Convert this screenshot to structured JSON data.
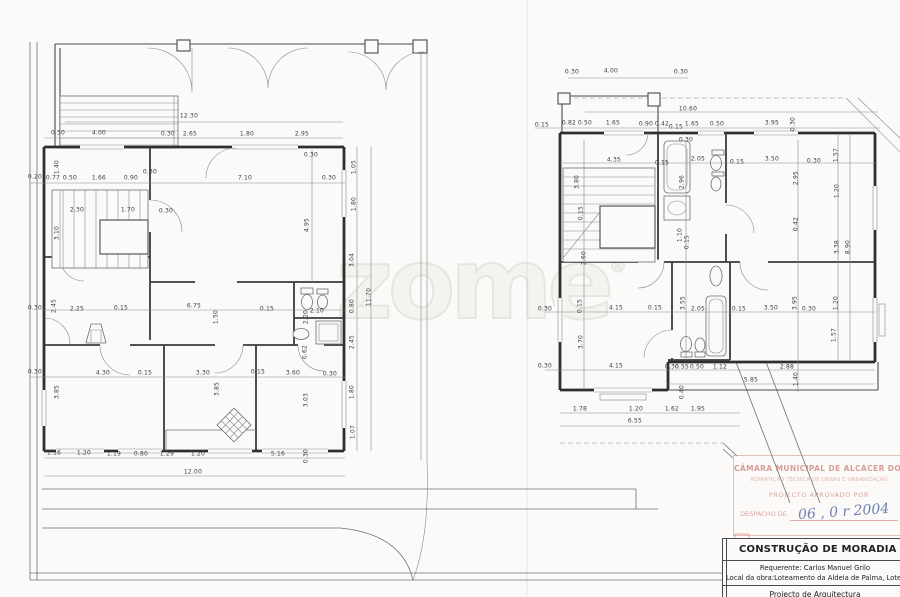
{
  "document": {
    "kind": "scanned architectural floor-plan sheet",
    "sheets": [
      "ground-floor-plan",
      "first-floor-plan"
    ]
  },
  "colors": {
    "paper": "#fbfaf8",
    "ink": "#3a3a3a",
    "stamp_red": "#c2645a",
    "handwriting_blue": "#5a6ba8",
    "watermark_gray": "#e9e9e5"
  },
  "watermark": {
    "text": "zome",
    "reg": "®"
  },
  "stamp": {
    "l1": "CÂMARA MUNICIPAL DE ALCÁCER DO SAL",
    "l2": "REPARTIÇÃO TÉCNICA DE OBRAS E URBANIZAÇÃO",
    "l3": "PROJECTO APROVADO POR",
    "l4": "DESPACHO DE",
    "handwritten": "06 , 0 r 2004"
  },
  "title_block": {
    "row1": "CONSTRUÇÃO DE MORADIA UNIFA",
    "row2": "Requerente: Carlos Manuel Grilo",
    "row3": "Local da obra:Loteamento da Aldeia de Palma, Lote 8",
    "row4": "Projecto de Arquitectura"
  },
  "fixtures_icons": [
    "stairs",
    "door-arc",
    "bathtub",
    "toilet",
    "bidet",
    "sink",
    "shower",
    "fireplace",
    "kitchen-sink"
  ],
  "plans": [
    {
      "name": "ground-floor-plan",
      "labels": [
        {
          "t": "12.30",
          "x": 189,
          "y": 116
        },
        {
          "t": "0.50",
          "x": 58,
          "y": 133
        },
        {
          "t": "4.00",
          "x": 99,
          "y": 133
        },
        {
          "t": "0.30",
          "x": 168,
          "y": 134
        },
        {
          "t": "2.65",
          "x": 190,
          "y": 134
        },
        {
          "t": "1.80",
          "x": 247,
          "y": 134
        },
        {
          "t": "2.95",
          "x": 302,
          "y": 134
        },
        {
          "t": "0.30",
          "x": 311,
          "y": 155
        },
        {
          "t": "1.05",
          "x": 354,
          "y": 167,
          "v": 1
        },
        {
          "t": "0.20",
          "x": 35,
          "y": 177
        },
        {
          "t": "0.77",
          "x": 53,
          "y": 178
        },
        {
          "t": "0.50",
          "x": 70,
          "y": 178
        },
        {
          "t": "1.66",
          "x": 99,
          "y": 178
        },
        {
          "t": "0.90",
          "x": 131,
          "y": 178
        },
        {
          "t": "0.30",
          "x": 150,
          "y": 172
        },
        {
          "t": "7.10",
          "x": 245,
          "y": 178
        },
        {
          "t": "0.30",
          "x": 329,
          "y": 178
        },
        {
          "t": "1.40",
          "x": 57,
          "y": 167,
          "v": 1
        },
        {
          "t": "2.30",
          "x": 77,
          "y": 210
        },
        {
          "t": "1.70",
          "x": 128,
          "y": 210
        },
        {
          "t": "0.30",
          "x": 166,
          "y": 211
        },
        {
          "t": "3.10",
          "x": 57,
          "y": 233,
          "v": 1
        },
        {
          "t": "4.95",
          "x": 307,
          "y": 225,
          "v": 1
        },
        {
          "t": "1.80",
          "x": 354,
          "y": 204,
          "v": 1
        },
        {
          "t": "3.04",
          "x": 352,
          "y": 260,
          "v": 1
        },
        {
          "t": "0.80",
          "x": 352,
          "y": 306,
          "v": 1
        },
        {
          "t": "2.45",
          "x": 352,
          "y": 342,
          "v": 1
        },
        {
          "t": "1.80",
          "x": 352,
          "y": 392,
          "v": 1
        },
        {
          "t": "11.70",
          "x": 369,
          "y": 297,
          "v": 1
        },
        {
          "t": "1.07",
          "x": 353,
          "y": 432,
          "v": 1
        },
        {
          "t": "0.30",
          "x": 35,
          "y": 308
        },
        {
          "t": "2.45",
          "x": 54,
          "y": 306,
          "v": 1
        },
        {
          "t": "2.25",
          "x": 77,
          "y": 309
        },
        {
          "t": "0.15",
          "x": 121,
          "y": 308
        },
        {
          "t": "6.75",
          "x": 194,
          "y": 306
        },
        {
          "t": "1.50",
          "x": 216,
          "y": 317,
          "v": 1
        },
        {
          "t": "0.15",
          "x": 267,
          "y": 309
        },
        {
          "t": "2.10",
          "x": 317,
          "y": 311
        },
        {
          "t": "2.20",
          "x": 306,
          "y": 317,
          "v": 1
        },
        {
          "t": "0.62",
          "x": 305,
          "y": 352,
          "v": 1
        },
        {
          "t": "0.30",
          "x": 35,
          "y": 372
        },
        {
          "t": "4.30",
          "x": 103,
          "y": 373
        },
        {
          "t": "0.15",
          "x": 145,
          "y": 373
        },
        {
          "t": "3.30",
          "x": 203,
          "y": 373
        },
        {
          "t": "0.15",
          "x": 258,
          "y": 372
        },
        {
          "t": "3.60",
          "x": 293,
          "y": 373
        },
        {
          "t": "0.30",
          "x": 330,
          "y": 374
        },
        {
          "t": "3.85",
          "x": 57,
          "y": 392,
          "v": 1
        },
        {
          "t": "3.85",
          "x": 217,
          "y": 389,
          "v": 1
        },
        {
          "t": "3.03",
          "x": 306,
          "y": 400,
          "v": 1
        },
        {
          "t": "1.16",
          "x": 54,
          "y": 453
        },
        {
          "t": "1.20",
          "x": 84,
          "y": 453
        },
        {
          "t": "1.19",
          "x": 114,
          "y": 454
        },
        {
          "t": "0.80",
          "x": 141,
          "y": 454
        },
        {
          "t": "1.29",
          "x": 167,
          "y": 454
        },
        {
          "t": "1.20",
          "x": 198,
          "y": 454
        },
        {
          "t": "5.16",
          "x": 278,
          "y": 454
        },
        {
          "t": "0.30",
          "x": 306,
          "y": 456,
          "v": 1
        },
        {
          "t": "12.00",
          "x": 193,
          "y": 472
        }
      ]
    },
    {
      "name": "first-floor-plan",
      "labels": [
        {
          "t": "0.30",
          "x": 572,
          "y": 72
        },
        {
          "t": "4.00",
          "x": 611,
          "y": 71
        },
        {
          "t": "0.30",
          "x": 681,
          "y": 72
        },
        {
          "t": "10.60",
          "x": 688,
          "y": 109
        },
        {
          "t": "0.15",
          "x": 542,
          "y": 125
        },
        {
          "t": "0.82",
          "x": 569,
          "y": 123
        },
        {
          "t": "0.50",
          "x": 585,
          "y": 123
        },
        {
          "t": "1.65",
          "x": 613,
          "y": 123
        },
        {
          "t": "0.90",
          "x": 646,
          "y": 124
        },
        {
          "t": "0.42",
          "x": 662,
          "y": 124
        },
        {
          "t": "0.15",
          "x": 676,
          "y": 127
        },
        {
          "t": "1.65",
          "x": 692,
          "y": 124
        },
        {
          "t": "0.50",
          "x": 717,
          "y": 124
        },
        {
          "t": "3.95",
          "x": 772,
          "y": 123
        },
        {
          "t": "0.30",
          "x": 793,
          "y": 124,
          "v": 1
        },
        {
          "t": "0.30",
          "x": 686,
          "y": 140
        },
        {
          "t": "4.35",
          "x": 614,
          "y": 160
        },
        {
          "t": "0.15",
          "x": 662,
          "y": 163
        },
        {
          "t": "2.05",
          "x": 698,
          "y": 159
        },
        {
          "t": "0.15",
          "x": 737,
          "y": 162
        },
        {
          "t": "3.50",
          "x": 772,
          "y": 159
        },
        {
          "t": "0.30",
          "x": 814,
          "y": 161
        },
        {
          "t": "3.80",
          "x": 577,
          "y": 182,
          "v": 1
        },
        {
          "t": "0.15",
          "x": 581,
          "y": 213,
          "v": 1
        },
        {
          "t": "2.96",
          "x": 682,
          "y": 182,
          "v": 1
        },
        {
          "t": "2.95",
          "x": 796,
          "y": 178,
          "v": 1
        },
        {
          "t": "1.57",
          "x": 836,
          "y": 155,
          "v": 1
        },
        {
          "t": "1.20",
          "x": 837,
          "y": 191,
          "v": 1
        },
        {
          "t": "3.38",
          "x": 837,
          "y": 247,
          "v": 1
        },
        {
          "t": "8.90",
          "x": 848,
          "y": 247,
          "v": 1
        },
        {
          "t": "1.20",
          "x": 836,
          "y": 303,
          "v": 1
        },
        {
          "t": "1.57",
          "x": 834,
          "y": 335,
          "v": 1
        },
        {
          "t": "0.42",
          "x": 796,
          "y": 224,
          "v": 1
        },
        {
          "t": "1.10",
          "x": 680,
          "y": 235,
          "v": 1
        },
        {
          "t": "0.15",
          "x": 687,
          "y": 242,
          "v": 1
        },
        {
          "t": "2.60",
          "x": 584,
          "y": 258,
          "v": 1
        },
        {
          "t": "0.30",
          "x": 545,
          "y": 309
        },
        {
          "t": "0.15",
          "x": 580,
          "y": 306,
          "v": 1
        },
        {
          "t": "4.15",
          "x": 616,
          "y": 308
        },
        {
          "t": "0.15",
          "x": 655,
          "y": 308
        },
        {
          "t": "2.05",
          "x": 698,
          "y": 309
        },
        {
          "t": "0.15",
          "x": 739,
          "y": 309
        },
        {
          "t": "3.50",
          "x": 771,
          "y": 308
        },
        {
          "t": "0.30",
          "x": 809,
          "y": 309
        },
        {
          "t": "3.55",
          "x": 683,
          "y": 303,
          "v": 1
        },
        {
          "t": "3.95",
          "x": 795,
          "y": 303,
          "v": 1
        },
        {
          "t": "3.70",
          "x": 581,
          "y": 342,
          "v": 1
        },
        {
          "t": "0.30",
          "x": 545,
          "y": 366
        },
        {
          "t": "4.15",
          "x": 616,
          "y": 366
        },
        {
          "t": "0.30",
          "x": 672,
          "y": 367
        },
        {
          "t": "0.55",
          "x": 682,
          "y": 367
        },
        {
          "t": "0.50",
          "x": 697,
          "y": 367
        },
        {
          "t": "1.12",
          "x": 720,
          "y": 367
        },
        {
          "t": "2.88",
          "x": 787,
          "y": 367
        },
        {
          "t": "5.85",
          "x": 751,
          "y": 380
        },
        {
          "t": "1.40",
          "x": 796,
          "y": 379,
          "v": 1
        },
        {
          "t": "0.40",
          "x": 682,
          "y": 392,
          "v": 1
        },
        {
          "t": "1.78",
          "x": 580,
          "y": 409
        },
        {
          "t": "1.20",
          "x": 636,
          "y": 409
        },
        {
          "t": "1.62",
          "x": 672,
          "y": 409
        },
        {
          "t": "1.95",
          "x": 698,
          "y": 409
        },
        {
          "t": "6.55",
          "x": 635,
          "y": 421
        }
      ]
    }
  ]
}
